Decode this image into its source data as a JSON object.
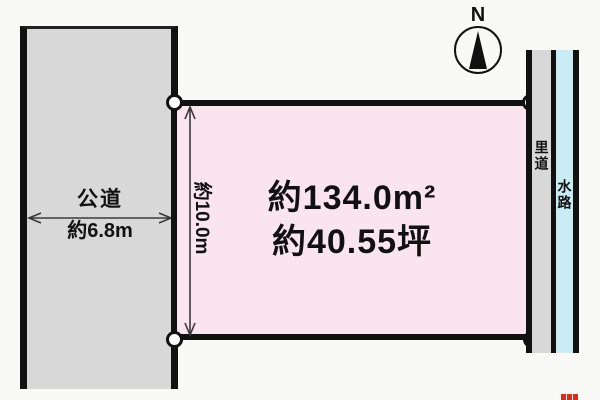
{
  "compass": {
    "north_label": "N"
  },
  "public_road": {
    "name": "公道",
    "width": "約6.8m"
  },
  "parcel": {
    "area_m2": "約134.0m²",
    "area_tsubo": "約40.55坪",
    "depth": "約10.0m"
  },
  "side_strips": {
    "rido": "里道",
    "waterway": "水路"
  },
  "colors": {
    "background": "#f9faf7",
    "road_gray": "#d8d8d8",
    "parcel_pink": "#fae5ef",
    "water_blue": "#c9ecf5",
    "ink": "#111111",
    "dim_line": "#3a3a3a",
    "watermark_red": "#d5301d"
  }
}
